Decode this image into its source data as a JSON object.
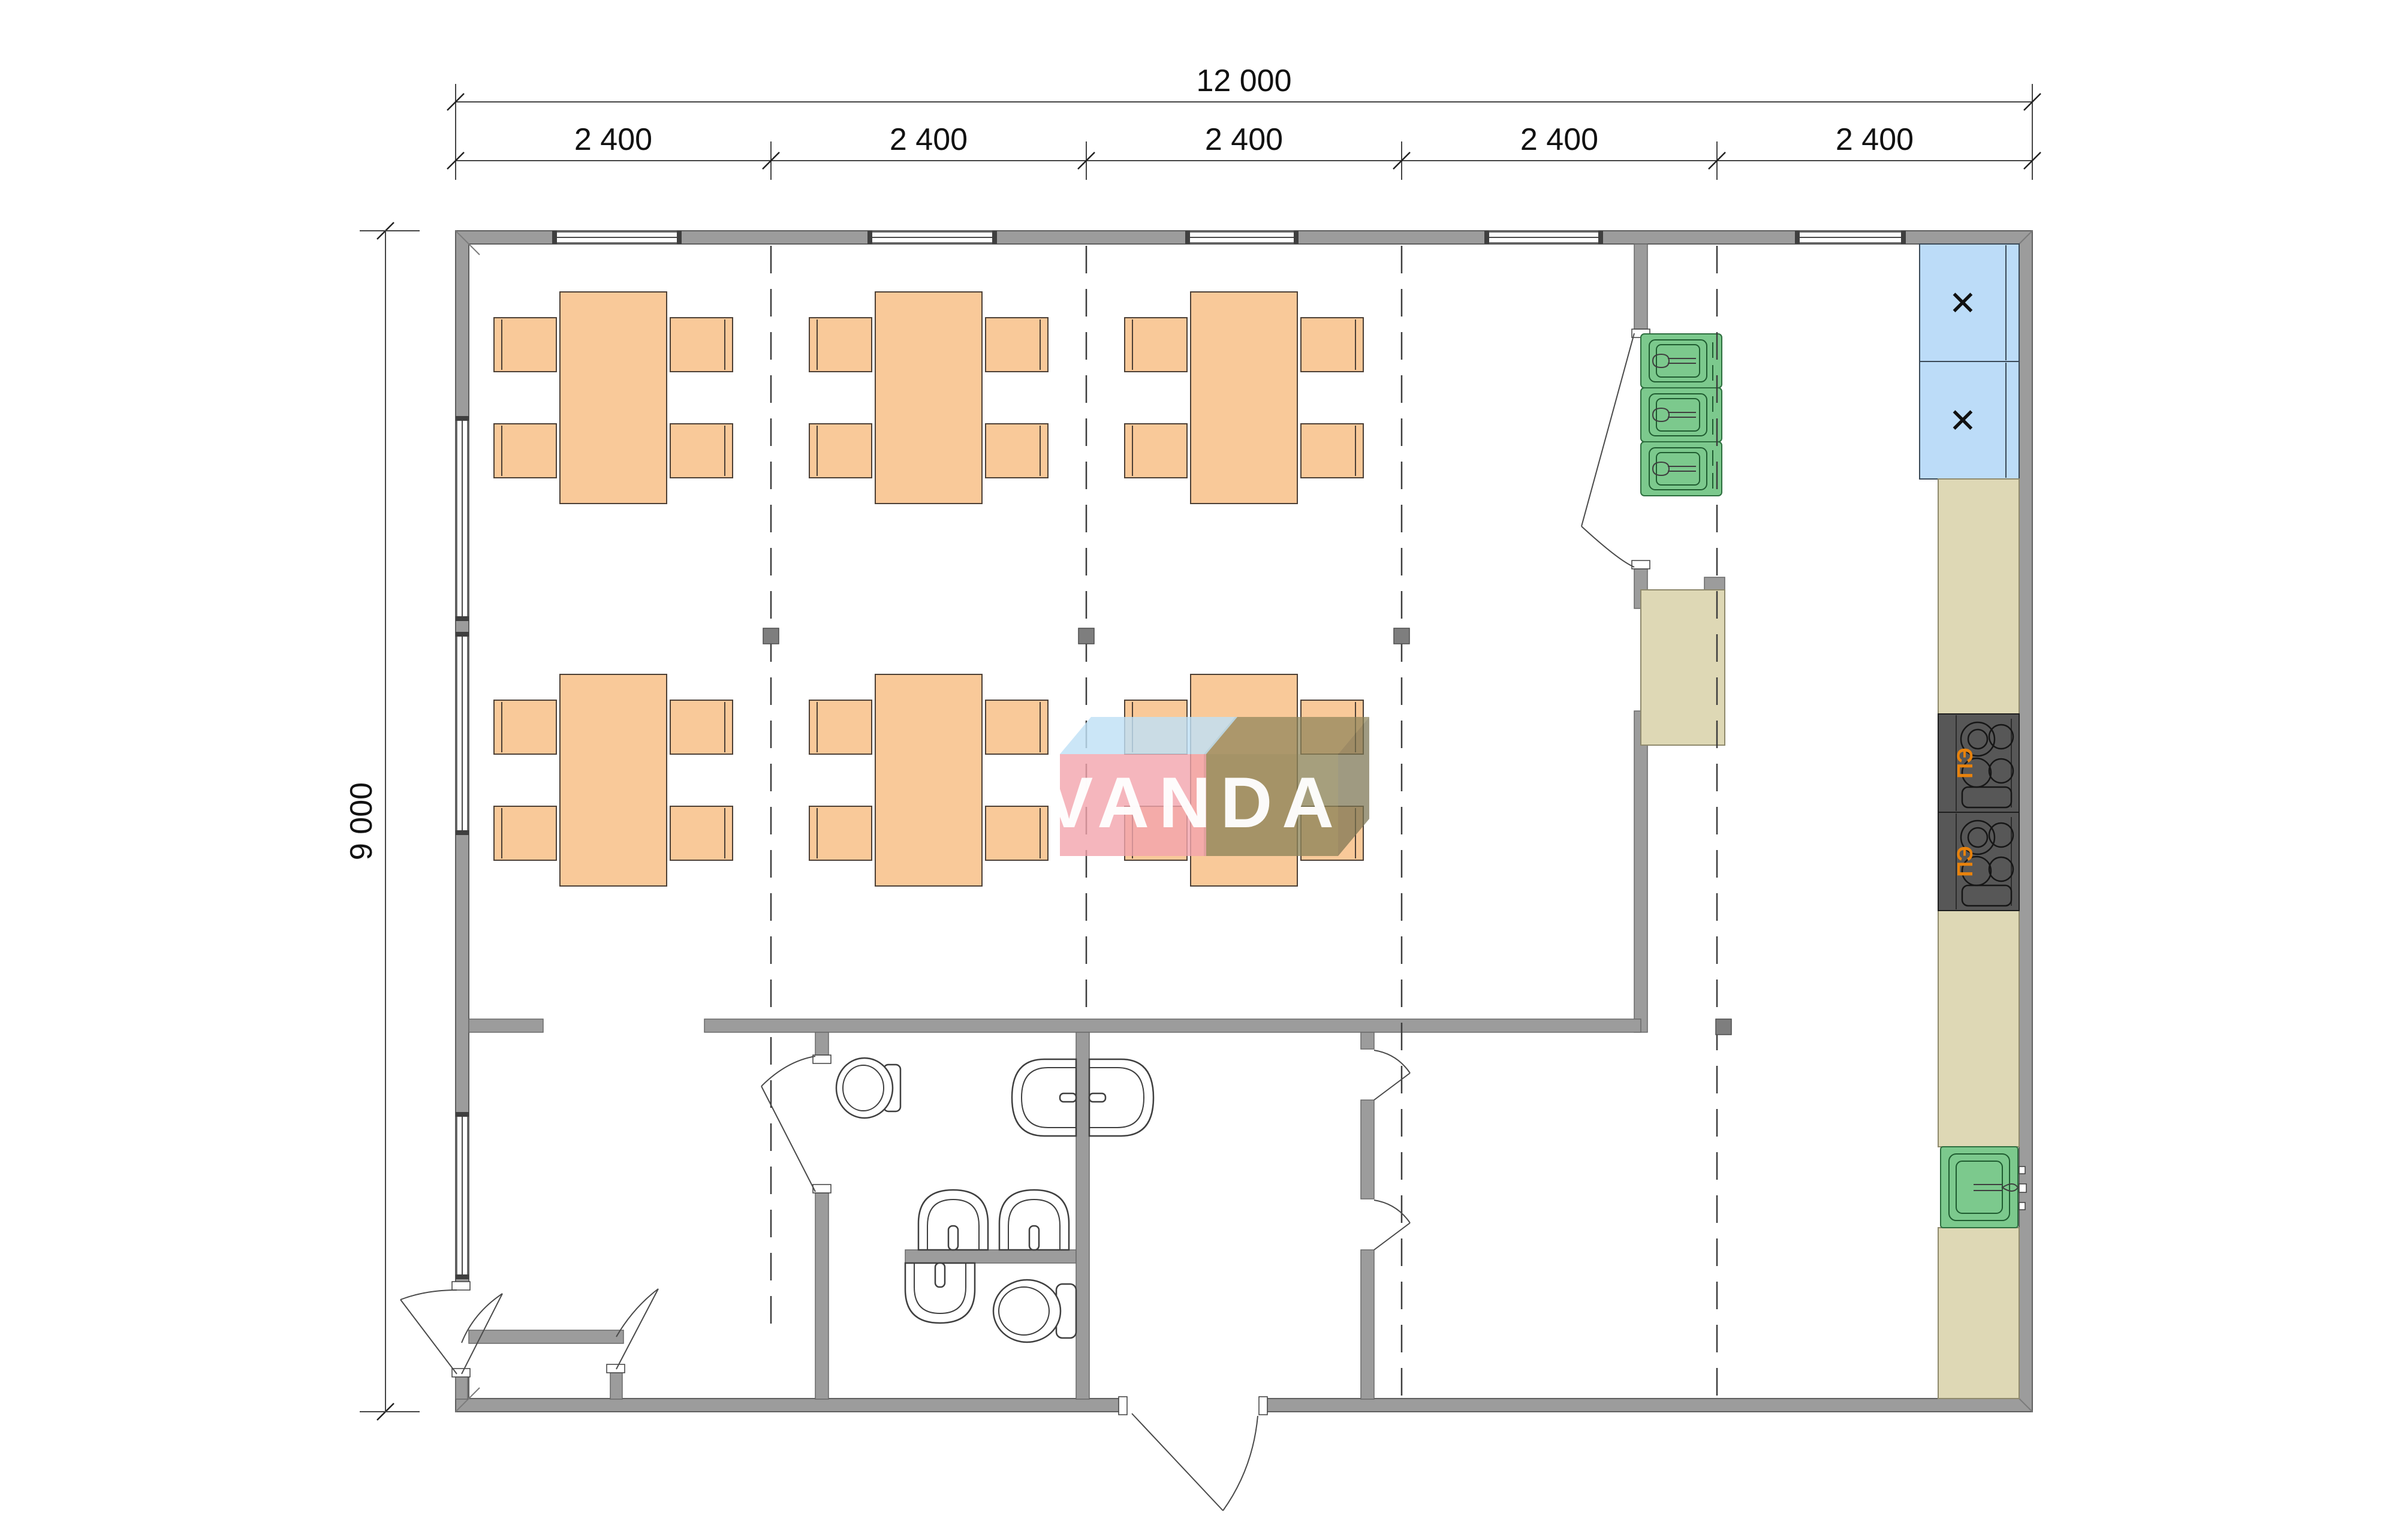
{
  "drawing_type": "floor-plan",
  "dimensions": {
    "total_width": "12 000",
    "height": "9 000",
    "segments": [
      "2 400",
      "2 400",
      "2 400",
      "2 400",
      "2 400"
    ]
  },
  "watermark": {
    "text": "VANDA"
  },
  "labels": {
    "stove": "ПЭ",
    "cabinet_x": "✕"
  },
  "equipment_counts": {
    "dining_table_groups": 6,
    "chairs_per_table": 4,
    "triple_sink_basins": 3,
    "electric_stoves": 2,
    "marked_cabinets": 2,
    "single_sinks": 1,
    "wash_basins": 5,
    "toilets": 2
  },
  "colors": {
    "wall": "#9c9c9c",
    "furniture": "#f9c999",
    "sink_green": "#7cc98d",
    "cabinet_blue": "#bcdcf8",
    "counter_beige": "#ded8b5",
    "stove_dark": "#575757",
    "stove_label_orange": "#e8820c",
    "watermark_pink": "#f2a4ac",
    "watermark_blue": "#bfe0f5",
    "watermark_olive": "#8d8459"
  }
}
